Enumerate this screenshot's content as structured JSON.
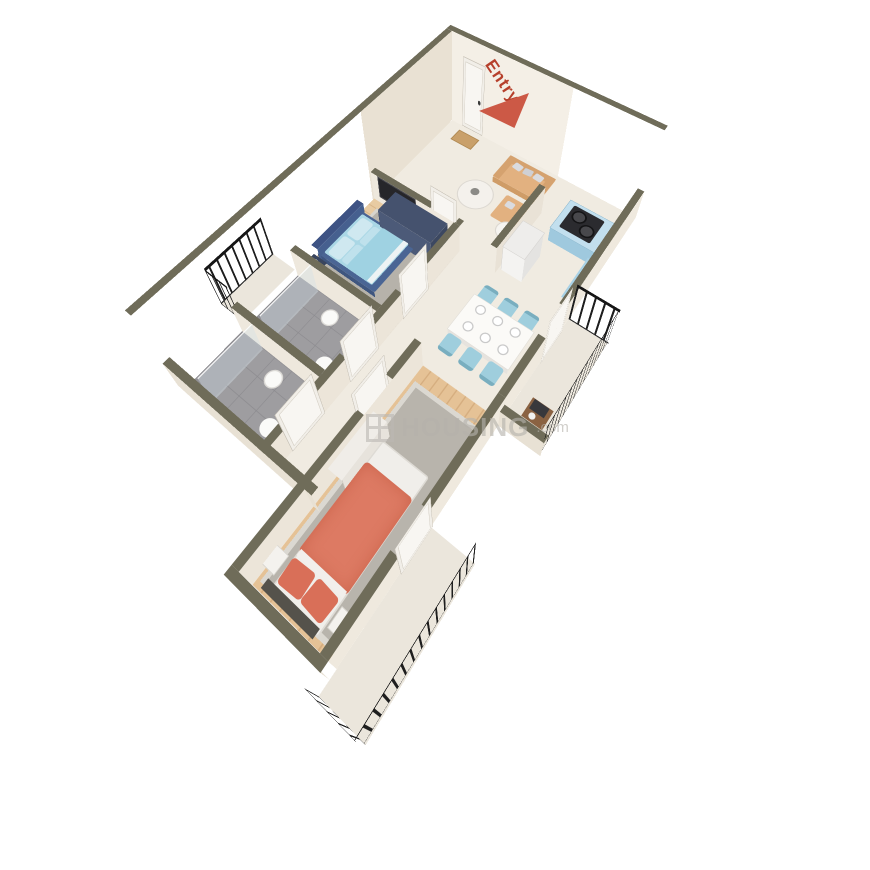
{
  "entry": {
    "label": "Entry",
    "arrow_color": "#cc5946",
    "text_color": "#b6402c"
  },
  "watermark": {
    "name": "HOUSING",
    "tld": ".com",
    "color": "#b5b2ac"
  },
  "palette": {
    "wall_top": "#6f6c59",
    "wall_face_light": "#f4efe6",
    "wall_face_shaded": "#e9e1d3",
    "floor_marble": "#f0ebe1",
    "floor_wood": "#e8cba2",
    "floor_tile": "#9e9da0",
    "kitchen_cabinet": "#a9d2e6",
    "cooktop": "#2b2b2f",
    "bed_frame_blue": "#4a6594",
    "bedding_light_blue": "#aad7e5",
    "bed_coral": "#dd7a63",
    "sofa_tan": "#e2b180",
    "dining_chair_blue": "#9fcedd",
    "wardrobe_navy": "#45526e",
    "railing_black": "#1e1e1e",
    "rug_gray": "#b6b2aa"
  }
}
